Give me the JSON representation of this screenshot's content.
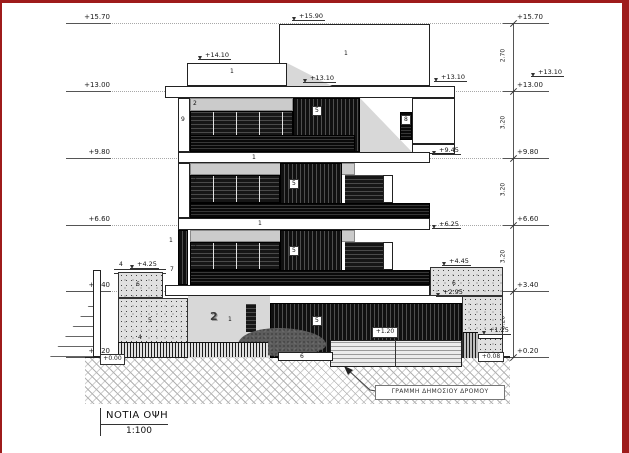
{
  "title_block": {
    "title": "ΝΟΤΙΑ ΟΨΗ",
    "scale": "1:100"
  },
  "levels": {
    "left": [
      "+15.70",
      "+13.00",
      "+9.80",
      "+6.60",
      "+3.40",
      "+0.20"
    ],
    "right": [
      "+15.70",
      "+13.00",
      "+9.80",
      "+6.60",
      "+3.40",
      "+0.20"
    ],
    "dims": [
      "2.70",
      "3.20",
      "3.20",
      "3.20",
      "3.20"
    ]
  },
  "spots": {
    "s1590": "+15.90",
    "s1410": "+14.10",
    "s1310": "+13.10",
    "s1310a": "+13.10",
    "s1310r": "+13.10",
    "s945": "+9.45",
    "s625": "+6.25",
    "s425": "+4.25",
    "s445": "+4.45",
    "s295": "+2.95",
    "s120": "+1.20",
    "s125": "+1.25",
    "s008": "+0.08",
    "s000": "+0.00"
  },
  "keynotes": {
    "n1": "1",
    "n2": "2",
    "n4": "4",
    "n5": "5",
    "n6": "6",
    "n7": "7",
    "n8": "8",
    "n9": "9"
  },
  "annotations": {
    "road_line": "ΓΡΑΜΜΗ ΔΗΜΟΣΙΟΥ ΔΡΟΜΟΥ",
    "unit_number": "2"
  },
  "frame": {
    "color": "#9e1b1b"
  }
}
